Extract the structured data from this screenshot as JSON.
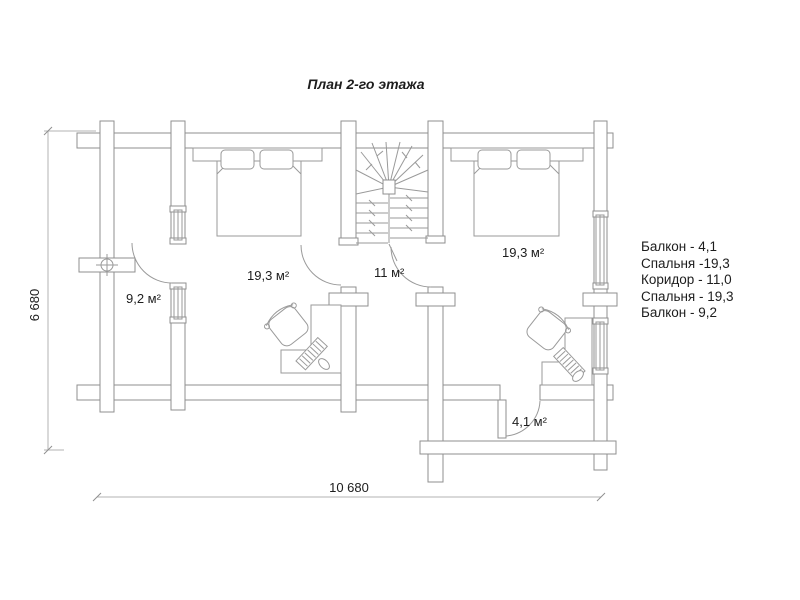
{
  "title": "План 2-го этажа",
  "plan": {
    "rooms": {
      "balcony_left": "9,2 м²",
      "bedroom_left": "19,3 м²",
      "corridor": "11 м²",
      "bedroom_right": "19,3 м²",
      "balcony_bottom": "4,1 м²"
    },
    "dimensions": {
      "height": "6 680",
      "width": "10 680"
    }
  },
  "legend": {
    "items": [
      "Балкон  - 4,1",
      "Спальня -19,3",
      "Коридор - 11,0",
      "Спальня - 19,3",
      "Балкон - 9,2"
    ]
  },
  "colors": {
    "background": "#ffffff",
    "wall_line": "#8f8f8f",
    "furniture_line": "#9a9a9a",
    "dimension_line": "#b3b3b3",
    "text": "#1d1d1d"
  }
}
